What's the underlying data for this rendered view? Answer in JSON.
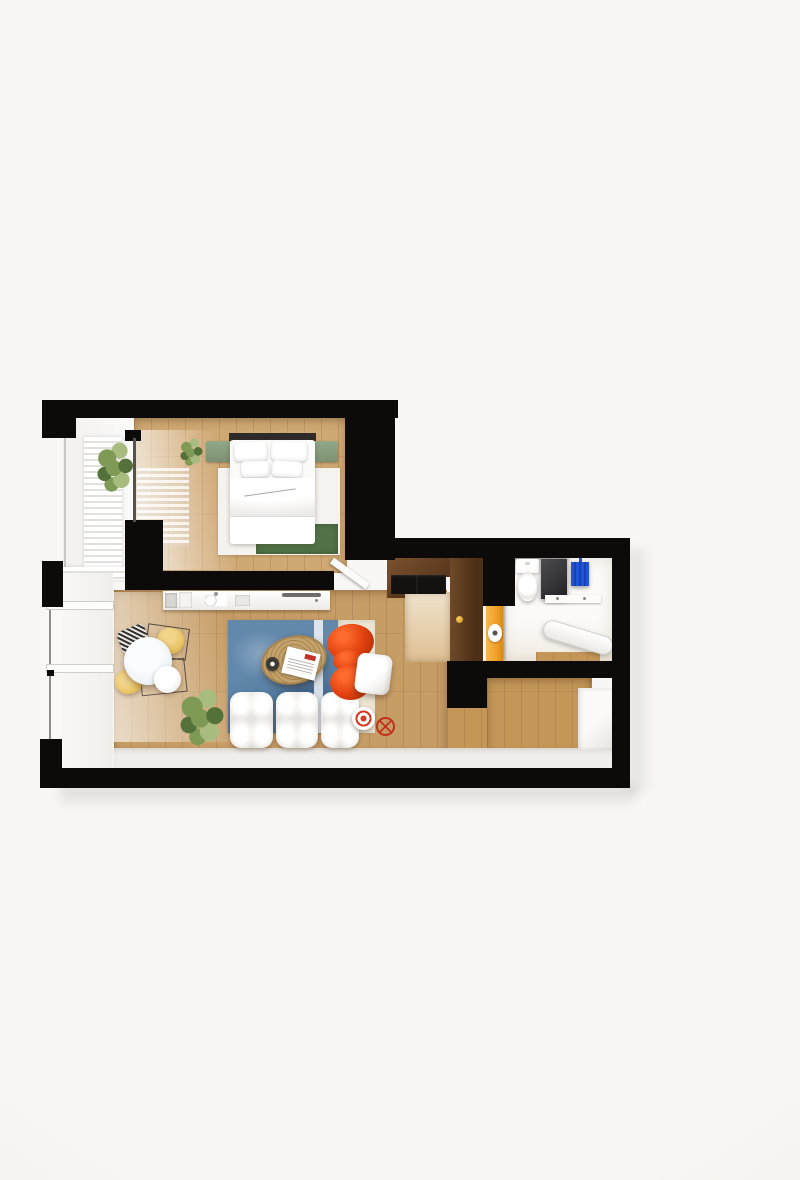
{
  "scene": {
    "type": "3d-floor-plan-render",
    "view": "top-down dollhouse cutaway",
    "backdrop": "plain off-white studio background",
    "visible_text": "none",
    "apartment": "one-bedroom apartment with balcony strip on the left"
  },
  "palette": {
    "bg": "#f8f7f5",
    "wall": "#0c0b09",
    "woodBedroom": "#d0a873",
    "woodLiving": "#c79d66",
    "woodHall": "#c49758",
    "woodNook": "#dfc093",
    "darkWood": "#59371d",
    "darkWoodLight": "#7a5231",
    "gloss": "#efedeb",
    "white": "#ffffff",
    "sage": "#92a786",
    "greenRug": "#507246",
    "blueRug": "#6288ac",
    "blueRugDeep": "#3f658b",
    "rugCream": "#ece4d2",
    "redChair": "#e0400f",
    "redDeep": "#a92d04",
    "yellowChair": "#e9c464",
    "jute": "#c3a26c",
    "juteDeep": "#a8854f",
    "doorOrange": "#f1a32d",
    "towelBlue": "#1e55d8",
    "showerDark": "#343437",
    "shelfGray": "#58575b",
    "glassLine": "#8f8d89",
    "plantDark": "#55713a",
    "plantMid": "#7e9a55",
    "plantLight": "#a9bc80",
    "gold": "#d9a62b"
  },
  "rooms": [
    {
      "id": "bedroom",
      "name": "Bedroom",
      "floor": "light oak planks",
      "items": [
        "double bed with white duvet",
        "four white pillows",
        "dark headboard",
        "sage green bedside benches (2)",
        "white area rug",
        "green accent rug at bed foot",
        "potted plant in corner",
        "black built-in wardrobe",
        "sheer rippled curtain",
        "open white door leaf"
      ]
    },
    {
      "id": "bedroom-balcony",
      "name": "Bedroom balcony",
      "floor": "white",
      "items": [
        "white louvered screen",
        "green potted plants (2)"
      ]
    },
    {
      "id": "living-room",
      "name": "Living room with kitchenette",
      "floor": "oak planks + glossy white strip",
      "items": [
        "white kitchen counter with sink, cooktop and small appliances",
        "round white dining table",
        "yellow shell chairs (2)",
        "black striped wire chair",
        "white chair",
        "blue and cream area rug",
        "oval jute coffee table",
        "open magazine",
        "dark coffee cup",
        "white modular puffy sofa (3 modules)",
        "red sculptural armchair",
        "white cube ottoman",
        "large potted plant",
        "white side table with red rings",
        "red wire stool"
      ]
    },
    {
      "id": "entry-nook",
      "name": "Entry / tall kitchen cabinets",
      "floor": "pale oak",
      "items": [
        "dark walnut tall cabinet run",
        "built-in black appliances",
        "dark walnut door with gold handle"
      ]
    },
    {
      "id": "bathroom",
      "name": "Bathroom",
      "floor": "white with oak strip",
      "items": [
        "toilet with cistern",
        "dark shower panel",
        "blue hanging towel",
        "dark wall shelf box",
        "white vanity shelf",
        "white bathtub (angled)",
        "orange door with toilet-paper roll"
      ]
    },
    {
      "id": "hallway",
      "name": "Hallway",
      "floor": "oak planks + glossy strip",
      "items": [
        "white built-in closet"
      ]
    }
  ],
  "glazing": [
    "bedroom balcony window line",
    "living room full-height glass wall with two white frame bars"
  ]
}
